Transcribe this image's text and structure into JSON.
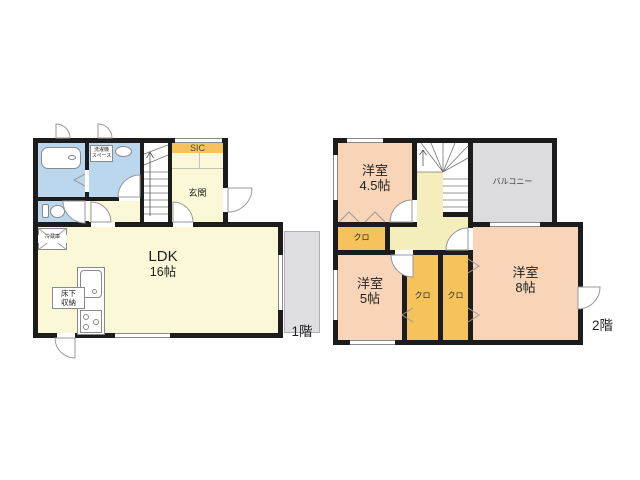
{
  "floors": {
    "floor1": {
      "name_label": "1階",
      "ldk_label": "LDK",
      "ldk_size": "16帖",
      "entrance_label": "玄関",
      "sic_label": "SIC",
      "laundry_space_line1": "洗濯機",
      "laundry_space_line2": "スペース",
      "underfloor_storage_line1": "床下",
      "underfloor_storage_line2": "収納",
      "refrigerator_label": "冷蔵庫"
    },
    "floor2": {
      "name_label": "2階",
      "room_45_label": "洋室",
      "room_45_size": "4.5帖",
      "room_5_label": "洋室",
      "room_5_size": "5帖",
      "room_8_label": "洋室",
      "room_8_size": "8帖",
      "closet_a_label": "クロ",
      "closet_b_label": "クロ",
      "closet_c_label": "クロ",
      "balcony_label": "バルコニー"
    }
  },
  "colors": {
    "wall": "#1c1c1c",
    "room_yellow": "#FBF8D8",
    "corridor_yellow": "#F4EEBC",
    "wet_room_blue": "#BBD7EE",
    "closet_orange": "#F5C25C",
    "bedroom_peach": "#F8D5B8",
    "balcony_gray": "#DCDCDF",
    "outline_gray": "#8a8a8a"
  }
}
